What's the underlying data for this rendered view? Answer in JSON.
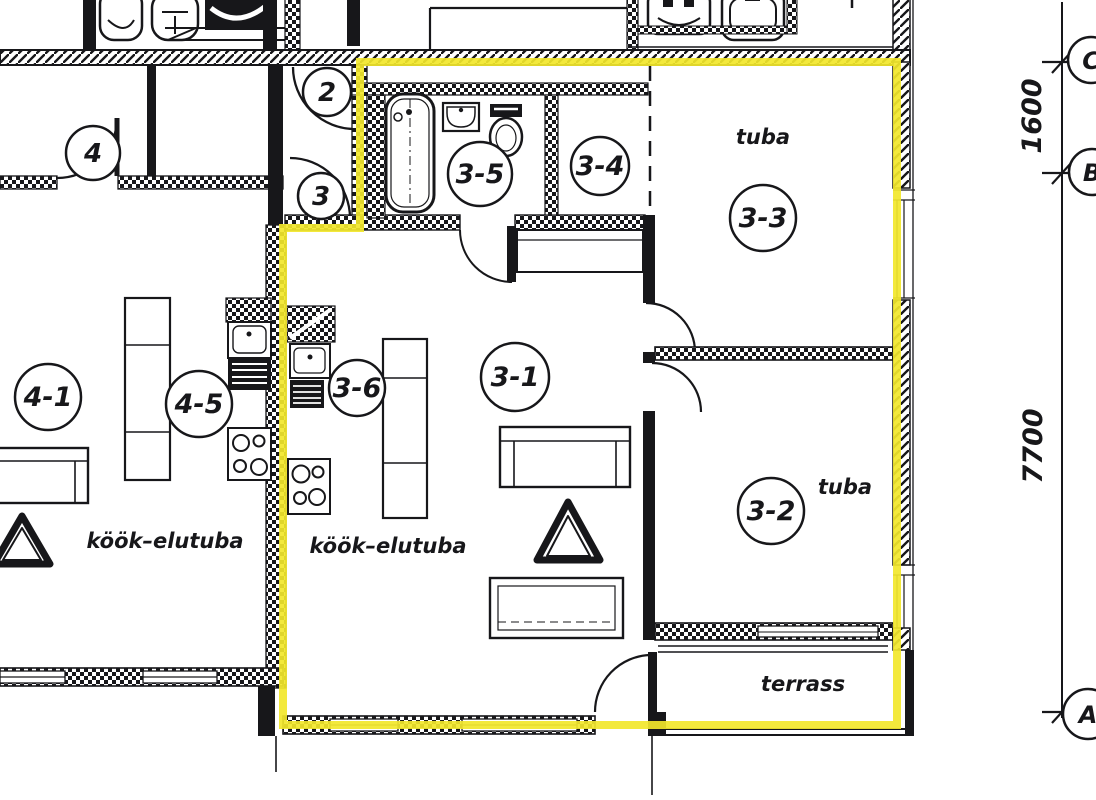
{
  "colors": {
    "highlight": "#f2e72b",
    "ink": "#17171a",
    "paper": "#ffffff"
  },
  "plan": {
    "apartment_3": {
      "living_room": {
        "id": "3-1",
        "label": "köök–elutuba"
      },
      "kitchen": {
        "id": "3-6"
      },
      "bathroom": {
        "id": "3-5"
      },
      "hallway": {
        "id": "3-4"
      },
      "bedroom_top": {
        "id": "3-3",
        "label": "tuba"
      },
      "bedroom_bottom": {
        "id": "3-2",
        "label": "tuba"
      },
      "terrace": {
        "label": "terrass"
      }
    },
    "apartment_4": {
      "living_room": {
        "id": "4-1",
        "label": "köök–elutuba"
      },
      "kitchen": {
        "id": "4-5"
      }
    },
    "entrance_doors": {
      "door_2": "2",
      "door_3": "3",
      "door_4": "4"
    }
  },
  "grid": {
    "markers": {
      "a": "A",
      "b": "B",
      "c": "C"
    },
    "dimensions": {
      "c_to_b": "1600",
      "b_to_a": "7700"
    }
  }
}
